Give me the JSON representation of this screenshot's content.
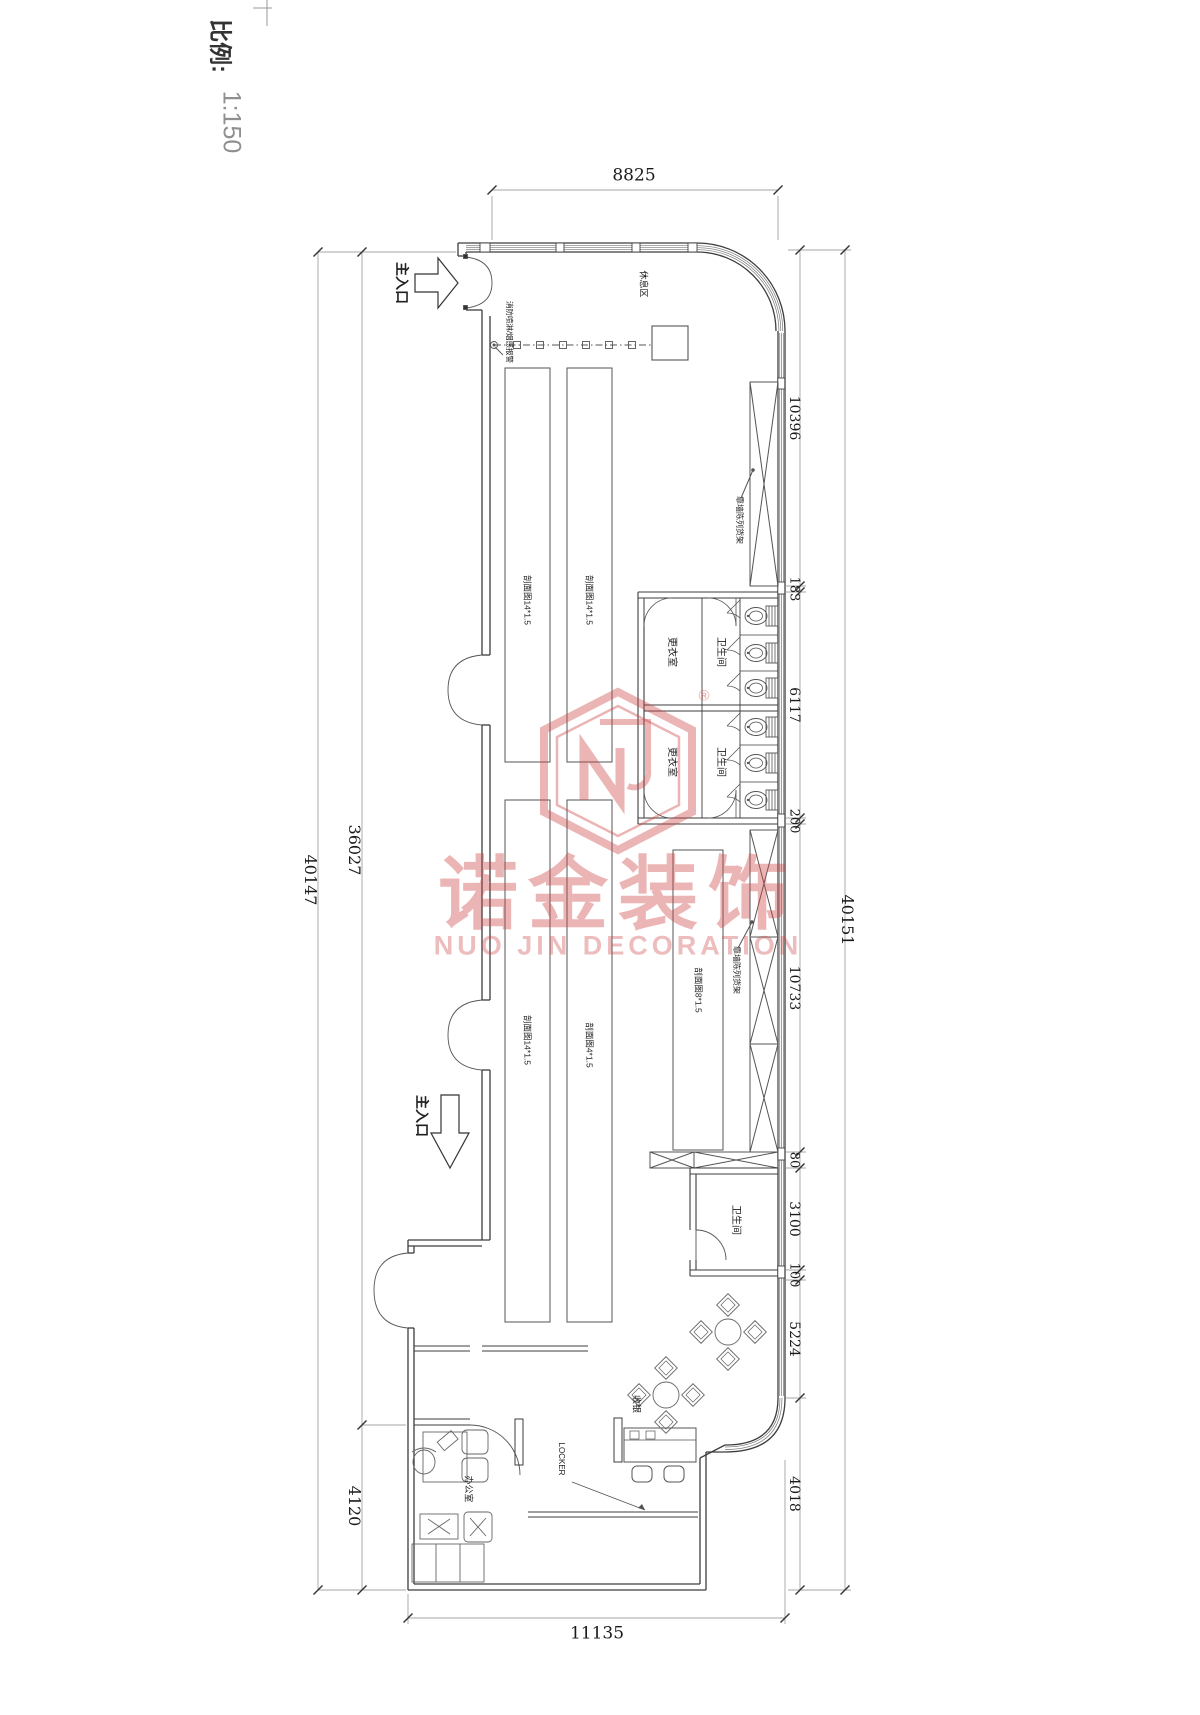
{
  "sheet": {
    "scale_prefix": "比例:",
    "scale_value": "1:150"
  },
  "watermark": {
    "cn": "诺金装饰",
    "en": "NUO JIN DECORATION",
    "registered": "®"
  },
  "dimensions": {
    "top": "8825",
    "bottom": "11135",
    "left_total": "40147",
    "left_main": "36027",
    "left_lower": "4120",
    "right_total": "40151",
    "right_chain": [
      "10396",
      "183",
      "6117",
      "200",
      "10733",
      "80",
      "3100",
      "100",
      "5224",
      "4018"
    ]
  },
  "labels": {
    "main_entrance": "主入口",
    "rest_area": "休息区",
    "sprinkler_note": "消防喷淋/烟感报警",
    "wall_display": "靠墙陈列货架",
    "gondola_14": "剖面图14*1.5",
    "gondola_4": "剖面图4*1.5",
    "gondola_8": "剖面图8*1.5",
    "changing_room": "更衣室",
    "toilet": "卫生间",
    "cashier": "收银",
    "office": "办公室",
    "locker": "LOCKER"
  }
}
